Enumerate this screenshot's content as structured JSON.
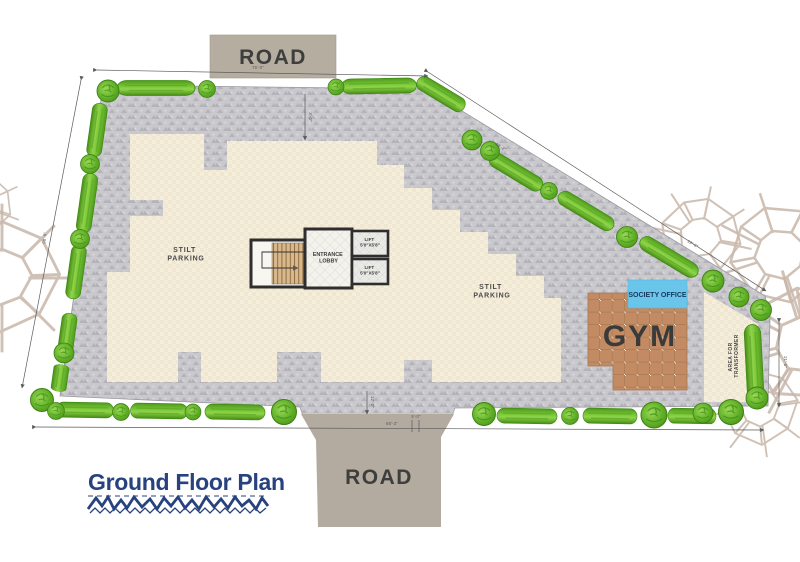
{
  "title": {
    "text": "Ground Floor Plan"
  },
  "roads": {
    "top_label": "ROAD",
    "bottom_label": "ROAD"
  },
  "areas": {
    "stilt_parking_left": {
      "line1": "STILT",
      "line2": "PARKING"
    },
    "stilt_parking_right": {
      "line1": "STILT",
      "line2": "PARKING"
    },
    "gym_label": "GYM",
    "society_office_label": "SOCIETY OFFICE",
    "transformer": {
      "line1": "AREA FOR",
      "line2": "TRANSFORMER"
    },
    "entrance_lobby": {
      "line1": "ENTRANCE",
      "line2": "LOBBY"
    },
    "lift1": {
      "name": "LIFT",
      "size": "5'0\"X5'8\""
    },
    "lift2": {
      "name": "LIFT",
      "size": "5'0\"X5'8\""
    }
  },
  "dimensions": {
    "top": "75'-0\"",
    "left": "98'-6\"",
    "bottom": "65'-3\"",
    "bottom_small": "5'-0\"",
    "diagonal_upper": "49'-2\"",
    "diagonal_lower": "19'-6\"",
    "right": "21'-0\"",
    "road_top_offset": "3'-0\"",
    "road_bottom_offset": "12'-2\""
  },
  "colors": {
    "paving": "#c9c8cd",
    "paving_texture": "#b3b2b8",
    "stilt_floor": "#f5eedb",
    "hedge_green": "#7dc93a",
    "tree_green": "#63b22a",
    "road_fill": "#b5aca0",
    "gym_tile": "#c38b63",
    "society_office_fill": "#6ac5ea",
    "title_navy": "#27427e",
    "wall": "#2e2e2e",
    "mandala": "#c8b7aa"
  },
  "icons": {
    "tree": "tree-icon",
    "hedge": "hedge-icon"
  }
}
